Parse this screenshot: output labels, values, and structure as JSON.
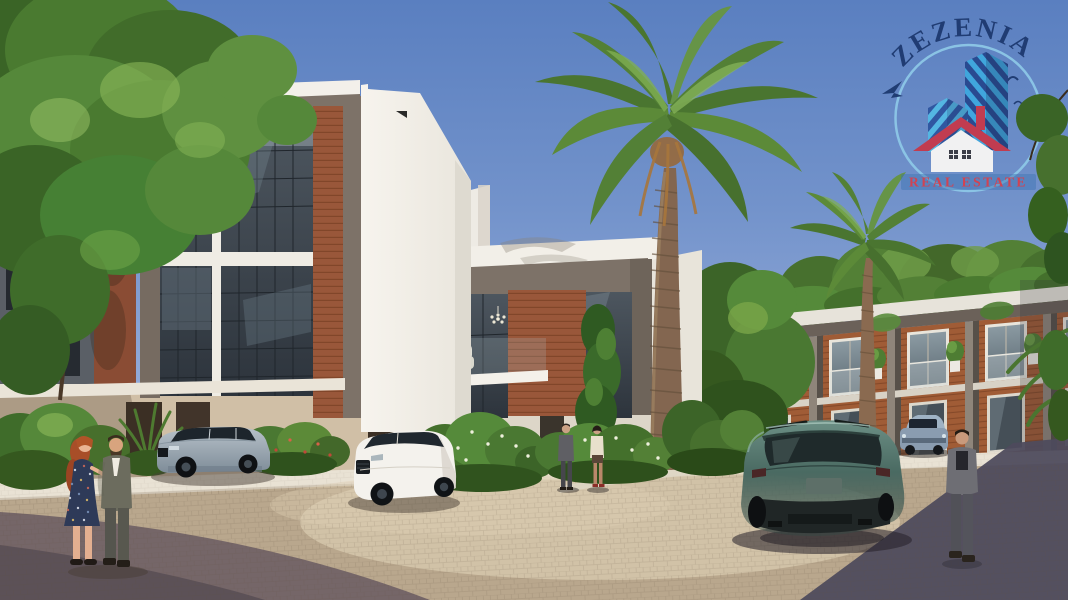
{
  "logo": {
    "brand": "ZEZENIA",
    "tagline": "REAL ESTATE",
    "colors": {
      "brand_text": "#1e3a70",
      "tagline_text": "#d5404e",
      "circle_ring": "#8ec9e8",
      "tower_light": "#3fa8de",
      "tower_dark": "#27488e",
      "roof_red": "#c5394c"
    }
  },
  "scene": {
    "description": "Sunlit 3D architectural rendering of a modern white villa compound with wood accents, large date palms, a leafy tree, parked silver and white SUVs, a teal SUV on a cobblestone street, and pedestrians in business attire.",
    "watermark_position": "top-right",
    "palette": {
      "sky_top": "#5a7fc0",
      "sky_horizon": "#d5dcea",
      "wall_white": "#f3f0ea",
      "frame_taupe": "#7d7268",
      "wood_accent": "#9a5a38",
      "glass_dark": "#3d444c",
      "ground_beige": "#d0bfa6",
      "road_sunlit": "#c3ab8f",
      "road_shadow_left": "#6e5f64",
      "road_shadow_right": "#4e4a5c",
      "palm_green": "#538036",
      "suv_teal": "#47645d"
    }
  }
}
